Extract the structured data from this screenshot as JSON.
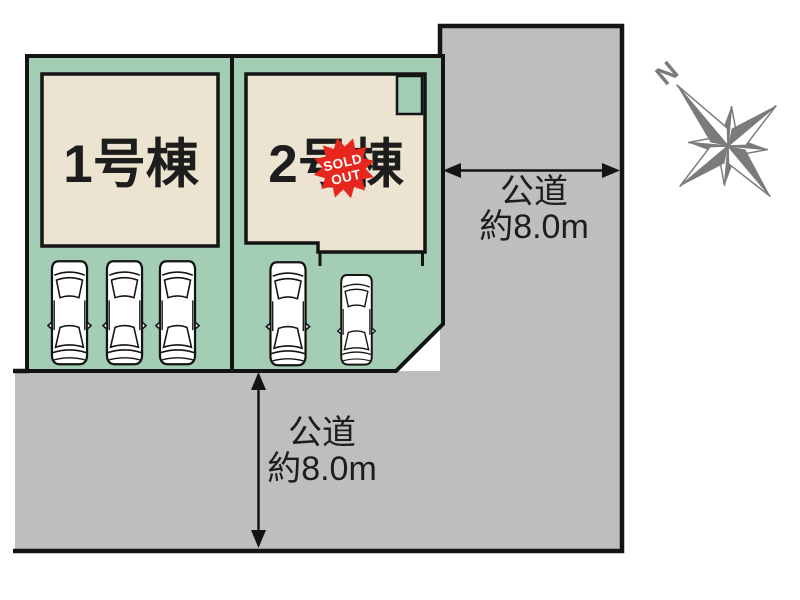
{
  "diagram": {
    "type": "real-estate-site-plan",
    "plots": [
      {
        "id": "plot-1",
        "building_label": "1号棟",
        "car_count": 3
      },
      {
        "id": "plot-2",
        "building_label": "2号棟",
        "car_count": 2,
        "badge": {
          "line1": "SOLD",
          "line2": "OUT"
        }
      }
    ],
    "roads": {
      "right": {
        "name": "公道",
        "width": "約8.0m"
      },
      "bottom": {
        "name": "公道",
        "width": "約8.0m"
      }
    },
    "compass": {
      "north_label": "N"
    },
    "colors": {
      "lot_green": "#a3ceb5",
      "building_beige": "#ece4d1",
      "road_gray": "#bebebe",
      "outline_black": "#141414",
      "compass_gray": "#7b7b7b",
      "sold_out_red": "#e7271d"
    }
  }
}
